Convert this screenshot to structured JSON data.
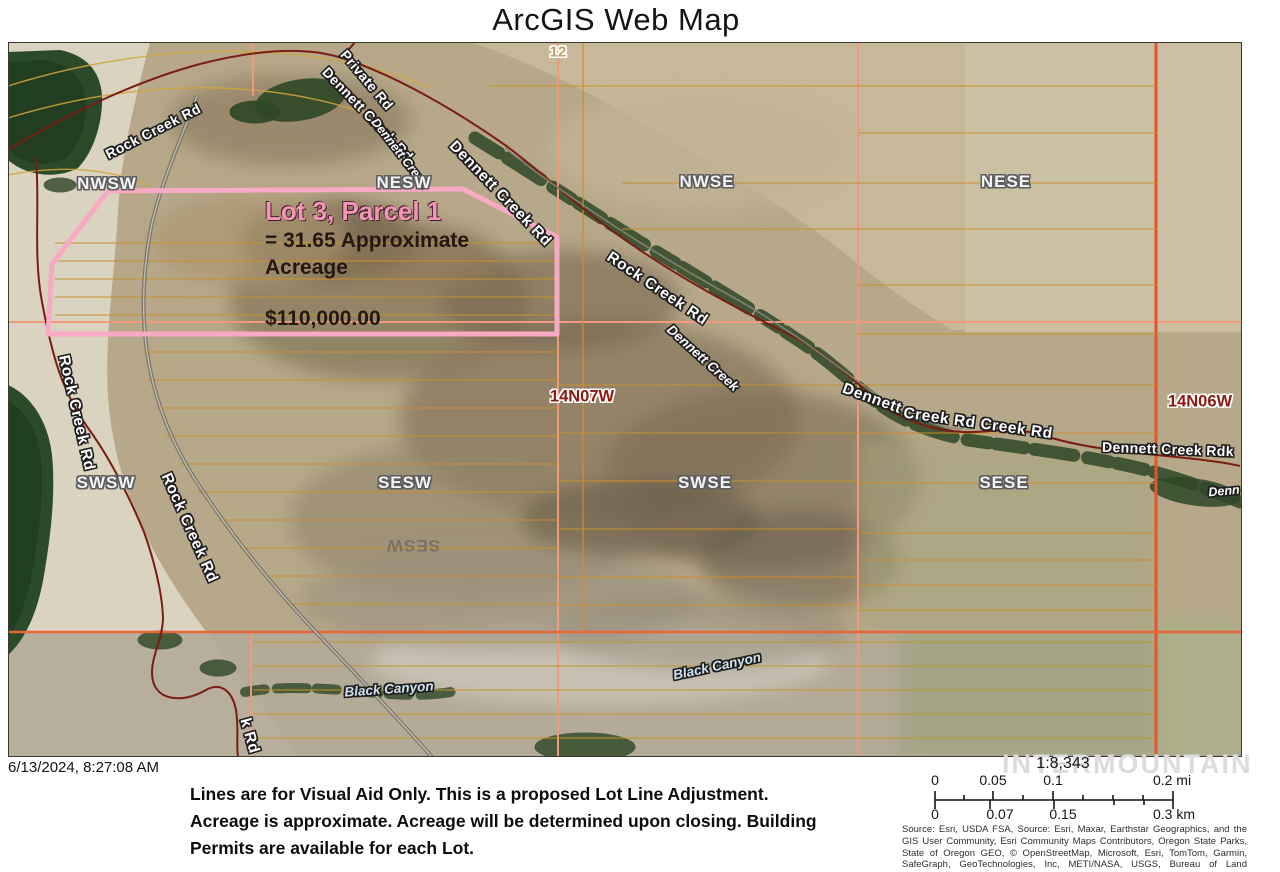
{
  "title": "ArcGIS Web Map",
  "map": {
    "parcel": {
      "name": "Lot 3, Parcel 1",
      "acreage_line1": "= 31.65 Approximate",
      "acreage_line2": "Acreage",
      "price": "$110,000.00",
      "outline_color": "#f8a9c4",
      "outline_points": "108,191 463,189 557,237 557,334 48,334 52,264"
    },
    "labels": [
      {
        "text": "12",
        "x": 558,
        "y": 52,
        "rot": 0,
        "kind": "secnum"
      },
      {
        "text": "Private Rd",
        "x": 367,
        "y": 80,
        "rot": 50,
        "kind": "road"
      },
      {
        "text": "Rock Creek Rd",
        "x": 153,
        "y": 131,
        "rot": -27,
        "kind": "road"
      },
      {
        "text": "Dennett Creek Rd",
        "x": 368,
        "y": 114,
        "rot": 46,
        "kind": "road"
      },
      {
        "text": "Dennett Creek",
        "x": 400,
        "y": 153,
        "rot": 52,
        "kind": "creeksm"
      },
      {
        "text": "Dennett Creek Rd",
        "x": 500,
        "y": 194,
        "rot": 46,
        "kind": "roadlg"
      },
      {
        "text": "Rock Creek Rd",
        "x": 657,
        "y": 289,
        "rot": 34,
        "kind": "roadlg"
      },
      {
        "text": "NWSW",
        "x": 107,
        "y": 184,
        "rot": 0,
        "kind": "section"
      },
      {
        "text": "NESW",
        "x": 404,
        "y": 183,
        "rot": 0,
        "kind": "section"
      },
      {
        "text": "NWSE",
        "x": 707,
        "y": 182,
        "rot": 0,
        "kind": "section"
      },
      {
        "text": "NESE",
        "x": 1006,
        "y": 182,
        "rot": 0,
        "kind": "section"
      },
      {
        "text": "SWSW",
        "x": 106,
        "y": 483,
        "rot": 0,
        "kind": "section"
      },
      {
        "text": "SESW",
        "x": 405,
        "y": 483,
        "rot": 0,
        "kind": "section"
      },
      {
        "text": "SWSE",
        "x": 705,
        "y": 483,
        "rot": 0,
        "kind": "section"
      },
      {
        "text": "SESE",
        "x": 1004,
        "y": 483,
        "rot": 0,
        "kind": "section"
      },
      {
        "text": "SESW",
        "x": 413,
        "y": 545,
        "rot": 180,
        "kind": "ghost"
      },
      {
        "text": "14N07W",
        "x": 582,
        "y": 397,
        "rot": 0,
        "kind": "township"
      },
      {
        "text": "14N06W",
        "x": 1200,
        "y": 402,
        "rot": 0,
        "kind": "township"
      },
      {
        "text": "Rock Creek Rd",
        "x": 76,
        "y": 413,
        "rot": 77,
        "kind": "roadlg"
      },
      {
        "text": "Rock Creek Rd",
        "x": 189,
        "y": 528,
        "rot": 66,
        "kind": "roadlg"
      },
      {
        "text": "Dennett Creek",
        "x": 703,
        "y": 358,
        "rot": 42,
        "kind": "creek"
      },
      {
        "text": "Dennett",
        "x": 872,
        "y": 399,
        "rot": 20,
        "kind": "roadlg"
      },
      {
        "text": "Creek Rd Creek Rd",
        "x": 978,
        "y": 424,
        "rot": 8,
        "kind": "roadlg"
      },
      {
        "text": "Dennett Creek Rdk",
        "x": 1168,
        "y": 449,
        "rot": 2,
        "kind": "road"
      },
      {
        "text": "Denn",
        "x": 1224,
        "y": 491,
        "rot": -5,
        "kind": "creeksm"
      },
      {
        "text": "Black Canyon",
        "x": 389,
        "y": 689,
        "rot": -4,
        "kind": "canyon"
      },
      {
        "text": "Black Canyon",
        "x": 717,
        "y": 666,
        "rot": -12,
        "kind": "canyon"
      },
      {
        "text": "k Rd",
        "x": 249,
        "y": 736,
        "rot": 74,
        "kind": "roadlg"
      }
    ],
    "grid": {
      "thin_color": "#c8922e",
      "major_lines": [
        {
          "x1": 558,
          "y1": 42,
          "x2": 558,
          "y2": 757,
          "c": "#f09a7c",
          "w": 2
        },
        {
          "x1": 858,
          "y1": 42,
          "x2": 858,
          "y2": 757,
          "c": "#f09a7c",
          "w": 2
        },
        {
          "x1": 8,
          "y1": 322,
          "x2": 1242,
          "y2": 322,
          "c": "#f09a7c",
          "w": 2
        },
        {
          "x1": 253,
          "y1": 42,
          "x2": 253,
          "y2": 96,
          "c": "#f09a7c",
          "w": 2
        },
        {
          "x1": 251,
          "y1": 632,
          "x2": 251,
          "y2": 757,
          "c": "#f09a7c",
          "w": 2
        },
        {
          "x1": 1156,
          "y1": 42,
          "x2": 1156,
          "y2": 757,
          "c": "#e2552f",
          "w": 3
        },
        {
          "x1": 8,
          "y1": 632,
          "x2": 1242,
          "y2": 632,
          "c": "#e8663a",
          "w": 2.5
        },
        {
          "x1": 583,
          "y1": 42,
          "x2": 583,
          "y2": 632,
          "c": "#c8922e",
          "w": 1.2
        }
      ],
      "thin_segments": [
        {
          "y": 243,
          "x1": 55,
          "x2": 556
        },
        {
          "y": 261,
          "x1": 55,
          "x2": 556
        },
        {
          "y": 279,
          "x1": 55,
          "x2": 556
        },
        {
          "y": 297,
          "x1": 55,
          "x2": 556
        },
        {
          "y": 315,
          "x1": 55,
          "x2": 556
        },
        {
          "y": 352,
          "x1": 140,
          "x2": 558
        },
        {
          "y": 380,
          "x1": 148,
          "x2": 558
        },
        {
          "y": 408,
          "x1": 156,
          "x2": 558
        },
        {
          "y": 436,
          "x1": 166,
          "x2": 558
        },
        {
          "y": 464,
          "x1": 180,
          "x2": 558
        },
        {
          "y": 492,
          "x1": 198,
          "x2": 558
        },
        {
          "y": 520,
          "x1": 218,
          "x2": 558
        },
        {
          "y": 548,
          "x1": 240,
          "x2": 558
        },
        {
          "y": 576,
          "x1": 262,
          "x2": 558
        },
        {
          "y": 604,
          "x1": 286,
          "x2": 558
        },
        {
          "y": 385,
          "x1": 558,
          "x2": 858
        },
        {
          "y": 433,
          "x1": 558,
          "x2": 858
        },
        {
          "y": 481,
          "x1": 558,
          "x2": 858
        },
        {
          "y": 529,
          "x1": 558,
          "x2": 858
        },
        {
          "y": 577,
          "x1": 558,
          "x2": 858
        },
        {
          "y": 605,
          "x1": 558,
          "x2": 858
        },
        {
          "y": 86,
          "x1": 490,
          "x2": 1156
        },
        {
          "y": 133,
          "x1": 858,
          "x2": 1156
        },
        {
          "y": 183,
          "x1": 622,
          "x2": 1156
        },
        {
          "y": 229,
          "x1": 622,
          "x2": 1156
        },
        {
          "y": 285,
          "x1": 858,
          "x2": 1156
        },
        {
          "y": 334,
          "x1": 858,
          "x2": 1156
        },
        {
          "y": 385,
          "x1": 858,
          "x2": 1156
        },
        {
          "y": 433,
          "x1": 858,
          "x2": 1156
        },
        {
          "y": 483,
          "x1": 858,
          "x2": 1156
        },
        {
          "y": 533,
          "x1": 858,
          "x2": 1156
        },
        {
          "y": 560,
          "x1": 858,
          "x2": 1156
        },
        {
          "y": 585,
          "x1": 858,
          "x2": 1156
        },
        {
          "y": 610,
          "x1": 858,
          "x2": 1156
        },
        {
          "y": 642,
          "x1": 253,
          "x2": 1156
        },
        {
          "y": 666,
          "x1": 253,
          "x2": 1156
        },
        {
          "y": 690,
          "x1": 253,
          "x2": 1156
        },
        {
          "y": 714,
          "x1": 253,
          "x2": 1156
        },
        {
          "y": 738,
          "x1": 253,
          "x2": 1156
        }
      ]
    }
  },
  "footer": {
    "date": "6/13/2024, 8:27:08 AM",
    "disclaimer_lines": [
      "Lines are for Visual Aid Only. This is a proposed Lot Line Adjustment.",
      "Acreage is approximate. Acreage will be determined upon closing. Building",
      "Permits are available for each Lot."
    ],
    "watermark": "INTERMOUNTAIN",
    "scale": {
      "ratio": "1:8,343",
      "mi_ticks": [
        {
          "label": "0",
          "x": 935
        },
        {
          "label": "0.05",
          "x": 993
        },
        {
          "label": "0.1",
          "x": 1053
        },
        {
          "label": "0.2 mi",
          "x": 1172
        }
      ],
      "km_ticks": [
        {
          "label": "0",
          "x": 935
        },
        {
          "label": "0.07",
          "x": 1000
        },
        {
          "label": "0.15",
          "x": 1063
        },
        {
          "label": "0.3 km",
          "x": 1174
        }
      ]
    },
    "attribution_lines": [
      "Source: Esri, USDA FSA, Source: Esri, Maxar, Earthstar Geographics, and the",
      "GIS User Community, Esri Community Maps Contributors, Oregon State Parks,",
      "State of Oregon GEO, © OpenStreetMap, Microsoft, Esri, TomTom, Garmin,",
      "SafeGraph,  GeoTechnologies,  Inc,  METI/NASA,  USGS,  Bureau  of  Land"
    ]
  }
}
